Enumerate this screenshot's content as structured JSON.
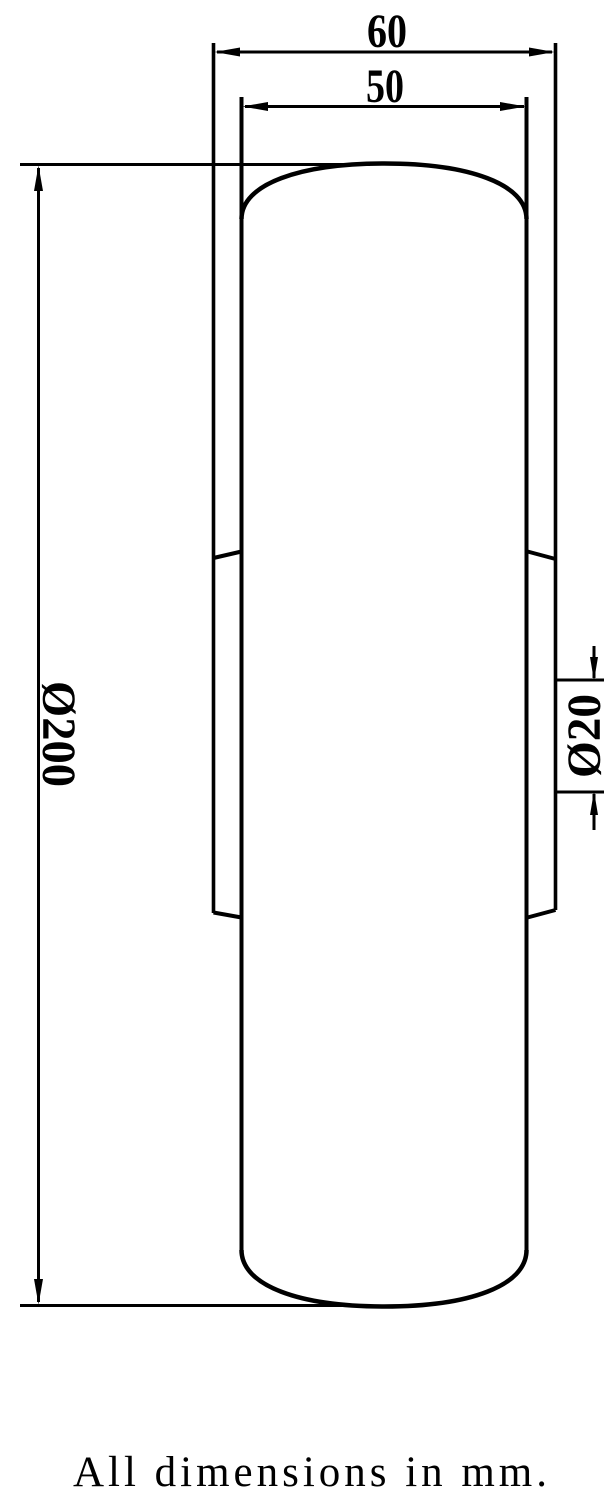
{
  "drawing": {
    "note": "All dimensions in mm.",
    "dimensions": {
      "hub_width": {
        "label": "60"
      },
      "tread_width": {
        "label": "50"
      },
      "wheel_diameter": {
        "label": "Ø200"
      },
      "bore_diameter": {
        "label": "Ø20"
      }
    },
    "colors": {
      "line": "#000000",
      "background": "#ffffff"
    }
  }
}
